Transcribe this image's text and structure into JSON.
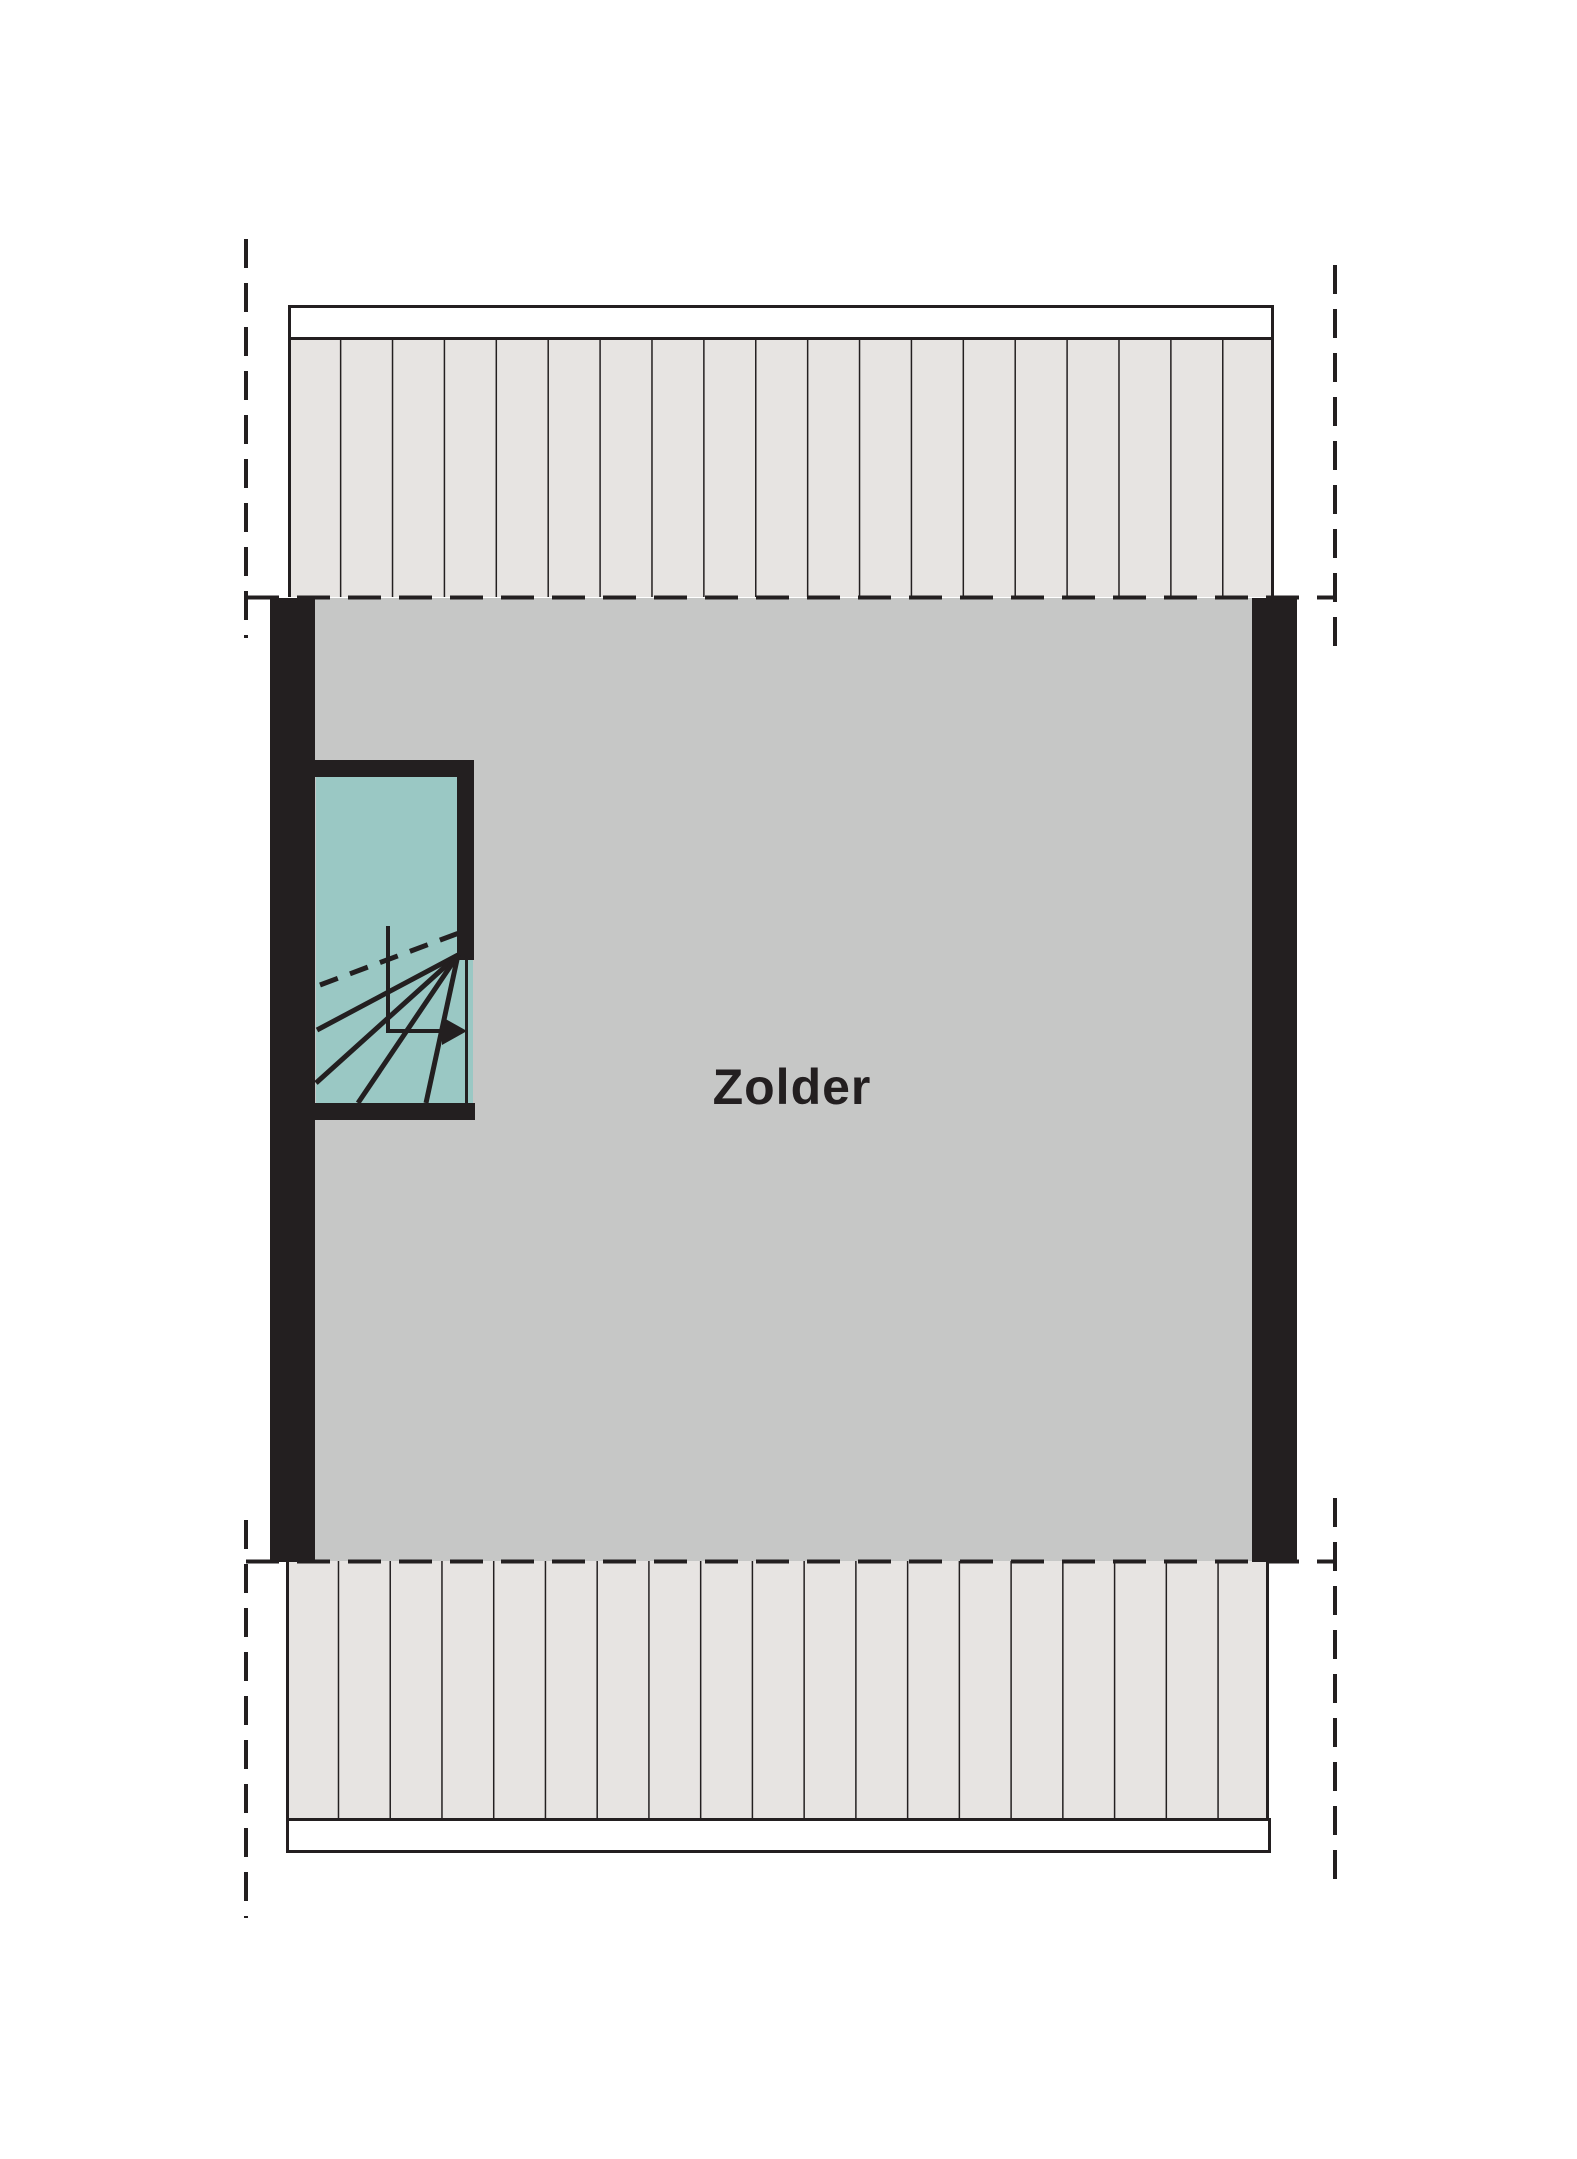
{
  "floorplan": {
    "room": {
      "label": "Zolder"
    },
    "colors": {
      "background": "#ffffff",
      "wall": "#231f20",
      "line": "#231f20",
      "floor": "#c6c7c6",
      "roof": "#e7e4e2",
      "stairs": "#9ac8c4"
    }
  }
}
